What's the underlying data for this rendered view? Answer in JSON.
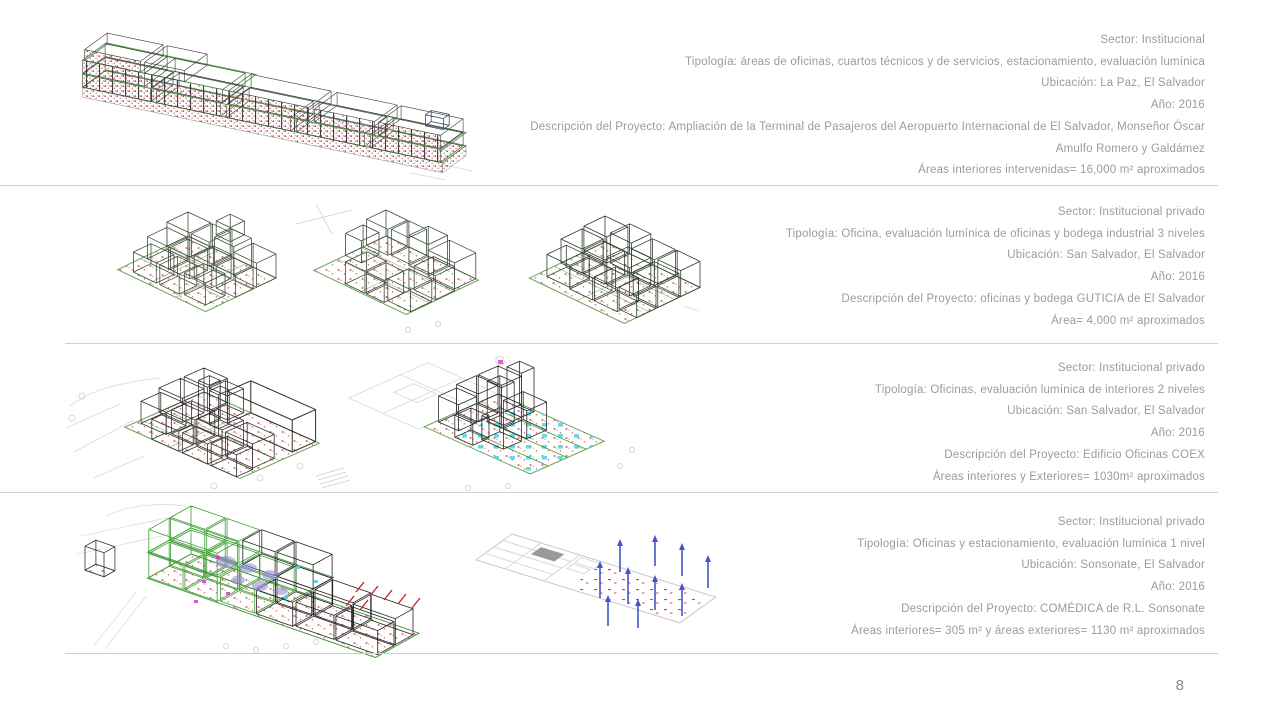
{
  "page": {
    "number": "8"
  },
  "projects": [
    {
      "sector": "Sector: Institucional",
      "tipologia": "Tipología: áreas de oficinas, cuartos técnicos y de servicios, estacionamiento, evaluación lumínica",
      "ubicacion": "Ubicación: La Paz, El Salvador",
      "anio": "Año: 2016",
      "descripcion": "Descripción del Proyecto: Ampliación de la Terminal de Pasajeros del Aeropuerto Internacional de El Salvador, Monseñor Óscar Amulfo Romero y Galdámez",
      "areas": "Áreas interiores intervenidas= 16,000 m² aproximados"
    },
    {
      "sector": "Sector: Institucional privado",
      "tipologia": "Tipología: Oficina, evaluación lumínica de oficinas y bodega industrial 3 niveles",
      "ubicacion": "Ubicación: San Salvador, El Salvador",
      "anio": "Año: 2016",
      "descripcion": "Descripción del Proyecto: oficinas y bodega GUTICIA de El Salvador",
      "areas": "Área= 4,000 m² aproximados"
    },
    {
      "sector": "Sector: Institucional privado",
      "tipologia": "Tipología: Oficinas, evaluación lumínica de interiores 2 niveles",
      "ubicacion": "Ubicación: San Salvador, El Salvador",
      "anio": "Año: 2016",
      "descripcion": "Descripción del Proyecto: Edificio Oficinas COEX",
      "areas": "Áreas interiores y Exteriores= 1030m² aproximados"
    },
    {
      "sector": "Sector: Institucional privado",
      "tipologia": "Tipología: Oficinas y estacionamiento, evaluación lumínica 1 nivel",
      "ubicacion": "Ubicación: Sonsonate, El Salvador",
      "anio": "Año: 2016",
      "descripcion": "Descripción del Proyecto: COMÉDICA de R.L. Sonsonate",
      "areas": "Áreas interiores= 305 m² y áreas exteriores= 1130 m² aproximados"
    }
  ]
}
